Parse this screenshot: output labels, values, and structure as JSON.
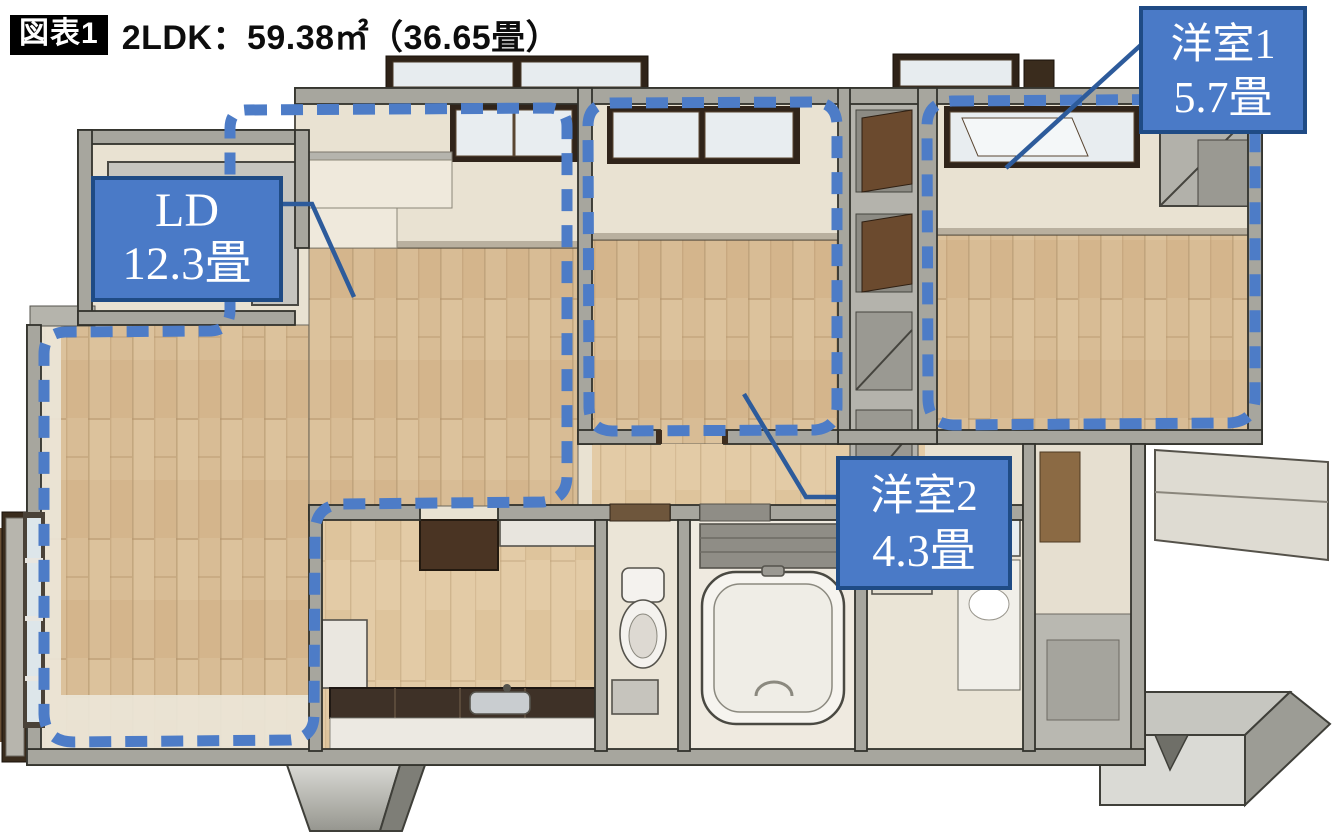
{
  "figure": {
    "badge": "図表1",
    "title": "2LDK：59.38㎡（36.65畳）"
  },
  "rooms": {
    "ld": {
      "label": "LD",
      "area": "12.3畳"
    },
    "western1": {
      "label": "洋室1",
      "area": "5.7畳"
    },
    "western2": {
      "label": "洋室2",
      "area": "4.3畳"
    }
  },
  "colors": {
    "label_fill": "#4a7ac7",
    "label_border": "#1f4b85",
    "label_text": "#ffffff",
    "dashed_outline": "#4d7cc7",
    "leader_line": "#2d5b9b",
    "badge_bg": "#000000",
    "badge_text": "#ffffff",
    "title_text": "#0d0d0d",
    "wall_gray": "#a7a69e",
    "wood_floor": "#d8bc95",
    "cream_floor": "#e9e2d2"
  }
}
